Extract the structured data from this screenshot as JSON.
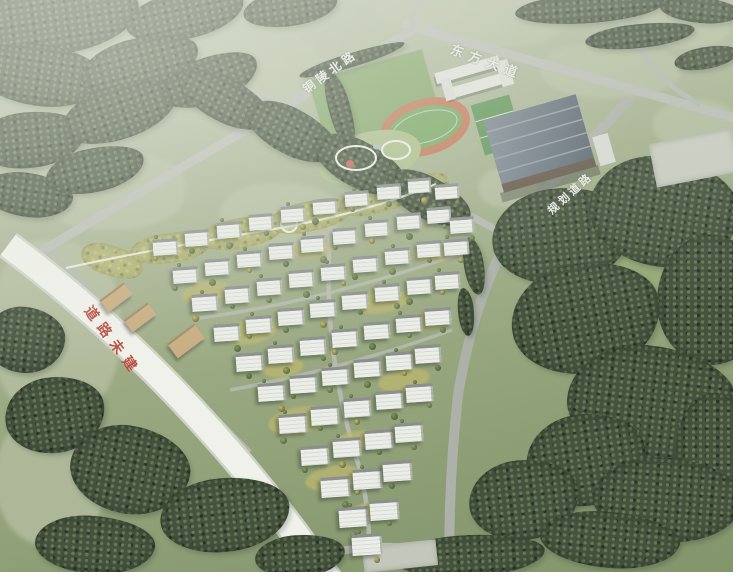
{
  "road_labels": {
    "north_road": {
      "text": "铜陵北路",
      "color": "#edefe8"
    },
    "east_avenue": {
      "text": "东方大道",
      "color": "#edefe8"
    },
    "planned_road": {
      "text": "规划道路",
      "color": "#edefe8"
    },
    "unbuilt_road": {
      "text": "道路未建",
      "color": "#b23b2c"
    }
  },
  "palette": {
    "field_green": "#9aa981",
    "meadow_green": "#8fa66e",
    "forest_green": "#35432f",
    "road_grey": "#b4b8b1",
    "road_white": "#f3f4ef",
    "track_orange": "#bf6e4a",
    "pitch_green": "#6ca156",
    "roof_blue_grey": "#5b6775",
    "building_white": "#eef0ec",
    "belt_yellow": "#c9ba55",
    "label_white": "#edefe8",
    "label_red": "#b23b2c"
  },
  "scene": {
    "fields": [
      [
        85,
        60,
        150,
        75
      ],
      [
        245,
        70,
        150,
        85
      ],
      [
        110,
        190,
        150,
        80
      ],
      [
        280,
        215,
        120,
        65
      ],
      [
        490,
        20,
        150,
        55
      ],
      [
        685,
        25,
        90,
        45
      ],
      [
        610,
        70,
        140,
        55
      ],
      [
        695,
        125,
        85,
        50
      ],
      [
        55,
        330,
        130,
        180
      ],
      [
        50,
        480,
        110,
        130
      ],
      [
        420,
        8,
        90,
        36
      ],
      [
        508,
        188,
        60,
        40
      ]
    ],
    "meadows": [
      [
        612,
        296,
        115,
        95
      ],
      [
        648,
        452,
        115,
        75
      ]
    ],
    "forests": [
      [
        55,
        20,
        170,
        70,
        -8
      ],
      [
        185,
        15,
        120,
        48,
        -12
      ],
      [
        290,
        8,
        95,
        36,
        -8
      ],
      [
        40,
        75,
        130,
        62,
        8
      ],
      [
        140,
        65,
        120,
        54,
        -14
      ],
      [
        30,
        140,
        110,
        56,
        -6
      ],
      [
        120,
        112,
        120,
        54,
        -18
      ],
      [
        210,
        80,
        100,
        46,
        -20
      ],
      [
        28,
        195,
        90,
        44,
        8
      ],
      [
        95,
        170,
        100,
        44,
        -12
      ],
      [
        225,
        100,
        100,
        44,
        28
      ],
      [
        292,
        132,
        100,
        46,
        28
      ],
      [
        360,
        165,
        100,
        46,
        28
      ],
      [
        428,
        198,
        92,
        42,
        28
      ],
      [
        590,
        8,
        150,
        30,
        -4
      ],
      [
        700,
        10,
        80,
        26,
        6
      ],
      [
        640,
        36,
        110,
        24,
        -6
      ],
      [
        706,
        58,
        64,
        22,
        -10
      ],
      [
        340,
        110,
        22,
        80,
        -16
      ],
      [
        352,
        60,
        110,
        14,
        -17
      ],
      [
        562,
        236,
        140,
        96,
        -6
      ],
      [
        664,
        212,
        150,
        110,
        8
      ],
      [
        712,
        300,
        110,
        130,
        0
      ],
      [
        586,
        318,
        150,
        110,
        -10
      ],
      [
        652,
        404,
        170,
        116,
        6
      ],
      [
        716,
        448,
        80,
        110,
        0
      ],
      [
        586,
        460,
        120,
        92,
        -8
      ],
      [
        668,
        500,
        150,
        84,
        4
      ],
      [
        524,
        500,
        110,
        80,
        -6
      ],
      [
        474,
        266,
        20,
        58,
        -10
      ],
      [
        466,
        312,
        16,
        48,
        -6
      ],
      [
        25,
        340,
        80,
        66,
        6
      ],
      [
        55,
        415,
        100,
        76,
        -8
      ],
      [
        130,
        470,
        120,
        88,
        10
      ],
      [
        225,
        515,
        130,
        74,
        -6
      ],
      [
        95,
        545,
        120,
        58,
        4
      ],
      [
        300,
        556,
        90,
        42,
        -4
      ],
      [
        470,
        556,
        150,
        42,
        -3
      ],
      [
        610,
        540,
        140,
        56,
        5
      ]
    ],
    "belt": [
      [
        112,
        261,
        64,
        30,
        18
      ],
      [
        170,
        248,
        80,
        30,
        -8
      ],
      [
        240,
        233,
        85,
        30,
        -10
      ],
      [
        310,
        216,
        85,
        30,
        -12
      ],
      [
        378,
        199,
        80,
        28,
        -14
      ],
      [
        425,
        187,
        50,
        24,
        -18
      ]
    ],
    "lawns": [
      [
        250,
        332,
        56,
        24
      ],
      [
        206,
        292,
        48,
        20
      ],
      [
        300,
        420,
        64,
        26
      ],
      [
        334,
        478,
        58,
        24
      ],
      [
        382,
        302,
        54,
        22
      ],
      [
        404,
        380,
        52,
        22
      ],
      [
        436,
        252,
        46,
        18
      ],
      [
        284,
        368,
        40,
        18
      ],
      [
        356,
        440,
        44,
        18
      ],
      [
        312,
        250,
        40,
        16
      ],
      [
        430,
        320,
        44,
        18
      ],
      [
        370,
        510,
        40,
        16
      ]
    ],
    "commercial": [
      [
        116,
        296,
        30,
        13
      ],
      [
        140,
        316,
        30,
        13
      ],
      [
        186,
        340,
        34,
        16
      ]
    ],
    "buildings": [
      [
        165,
        252
      ],
      [
        197,
        243
      ],
      [
        229,
        235
      ],
      [
        261,
        227
      ],
      [
        293,
        219
      ],
      [
        325,
        211
      ],
      [
        357,
        203
      ],
      [
        389,
        196
      ],
      [
        419,
        190
      ],
      [
        447,
        196
      ],
      [
        185,
        280
      ],
      [
        217,
        272
      ],
      [
        249,
        264
      ],
      [
        281,
        256
      ],
      [
        313,
        249
      ],
      [
        345,
        241
      ],
      [
        377,
        233
      ],
      [
        409,
        226
      ],
      [
        439,
        220
      ],
      [
        462,
        230
      ],
      [
        205,
        308
      ],
      [
        237,
        300
      ],
      [
        269,
        292
      ],
      [
        301,
        284
      ],
      [
        333,
        277
      ],
      [
        365,
        269
      ],
      [
        397,
        261
      ],
      [
        429,
        254
      ],
      [
        456,
        252
      ],
      [
        227,
        338
      ],
      [
        259,
        330
      ],
      [
        291,
        322
      ],
      [
        323,
        314
      ],
      [
        355,
        306
      ],
      [
        387,
        298
      ],
      [
        419,
        291
      ],
      [
        447,
        286
      ],
      [
        249,
        368
      ],
      [
        281,
        360
      ],
      [
        313,
        352
      ],
      [
        345,
        344
      ],
      [
        377,
        336
      ],
      [
        409,
        329
      ],
      [
        438,
        322
      ],
      [
        271,
        398
      ],
      [
        303,
        390
      ],
      [
        335,
        382
      ],
      [
        367,
        374
      ],
      [
        399,
        367
      ],
      [
        428,
        360
      ],
      [
        293,
        430
      ],
      [
        325,
        422
      ],
      [
        357,
        414
      ],
      [
        389,
        406
      ],
      [
        419,
        399
      ],
      [
        315,
        462
      ],
      [
        347,
        454
      ],
      [
        379,
        446
      ],
      [
        409,
        439
      ],
      [
        335,
        494
      ],
      [
        367,
        486
      ],
      [
        397,
        478
      ],
      [
        353,
        524
      ],
      [
        384,
        517
      ],
      [
        367,
        552
      ]
    ]
  }
}
